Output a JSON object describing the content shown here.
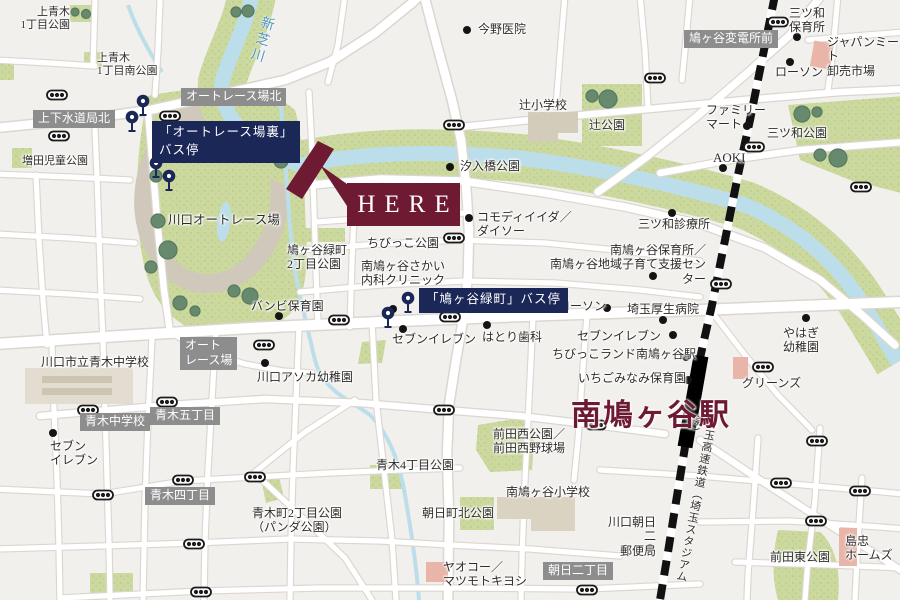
{
  "colors": {
    "accent_maroon": "#6d1a32",
    "bus_navy": "#1a2757",
    "district_gray": "#8d8d8d",
    "river_blue": "#bcdeea",
    "park_green": "#cbd89e",
    "background": "#f2f0ec"
  },
  "here": {
    "label": "HERE"
  },
  "station": {
    "name": "南鳩ヶ谷駅",
    "line_name": "埼玉高速鉄道（埼玉スタジアム線）"
  },
  "river": {
    "name": "新芝川"
  },
  "bus_stops": {
    "auto_race_ura": "「オートレース場裏」\nバス停",
    "hatogaya_midoricho": "「鳩ヶ谷緑町」バス停"
  },
  "district_labels": {
    "kamishimo_suidokyoku_kita": "上下水道局北",
    "auto_race_jo_kita": "オートレース場北",
    "hatogaya_hendensho_mae": "鳩ヶ谷変電所前",
    "auto_race_jo": "オート\nレース場",
    "aoki_chugakko": "青木中学校",
    "aoki_5chome": "青木五丁目",
    "aoki_4chome": "青木四丁目",
    "asahi_2chome": "朝日二丁目"
  },
  "places": {
    "kamiaoki_1chome_park": "上青木\n1丁目公園",
    "kamiaoki_1chome_minami_park": "上青木\n1丁目南公園",
    "masuda_jido_park": "増田児童公園",
    "konno_iin": "今野医院",
    "tsuji_shogakko": "辻小学校",
    "tsuji_park": "辻公園",
    "shioiribashi_park": "汐入橋公園",
    "mitsuwa_hoikusho": "三ツ和\n保育所",
    "japan_meat": "ジャパンミート\n卸売市場",
    "lawson_ne": "ローソン",
    "family_mart": "ファミリー\nマート",
    "mitsuwa_park": "三ツ和公園",
    "aoki_store": "AOKI",
    "kawaguchi_auto_race_jo": "川口オートレース場",
    "lawson_w": "ローソン",
    "hatogaya_midoricho_2chome_park": "鳩ヶ谷緑町\n2丁目公園",
    "chibikko_park": "ちびっこ公園",
    "minami_hatogaya_sakai_naika": "南鳩ヶ谷さかい\n内科クリニック",
    "komodi_iida_daiso": "コモディイイダ／\nダイソー",
    "mitsuwa_shinryojo": "三ツ和診療所",
    "minami_hatogaya_hoikusho_center": "南鳩ヶ谷保育所／\n南鳩ヶ谷地域子育て支援センター",
    "bambi_hoikuen": "バンビ保育園",
    "seven_eleven_center": "セブンイレブン",
    "hatori_shika": "はとり歯科",
    "lawson_e": "ローソン",
    "saitama_kosei_byoin": "埼玉厚生病院",
    "seven_eleven_e": "セブンイレブン",
    "chibikko_land": "ちびっこランド南鳩ヶ谷駅",
    "ichigo_minami_hoikuen": "いちごみなみ保育園",
    "yahagi_yochien": "やはぎ\n幼稚園",
    "greens": "グリーンズ",
    "kawaguchi_asoka_yochien": "川口アソカ幼稚園",
    "kawaguchi_shiritsu_aoki_chugakko": "川口市立青木中学校",
    "seven_eleven_sw": "セブン\nイレブン",
    "aoki_4chome_park": "青木4丁目公園",
    "maeda_nishi_park": "前田西公園／\n前田西野球場",
    "minami_hatogaya_shogakko": "南鳩ヶ谷小学校",
    "asahicho_kita_park": "朝日町北公園",
    "aokicho_2chome_park": "青木町2丁目公園\n（パンダ公園）",
    "yaoko_matsukiyo": "ヤオコー／\nマツモトキヨシ",
    "kawaguchi_asahi2_yubinkyoku": "川口朝日二\n郵便局",
    "maeda_higashi_park": "前田東公園",
    "shimachu_homes": "島忠\nホームズ"
  }
}
